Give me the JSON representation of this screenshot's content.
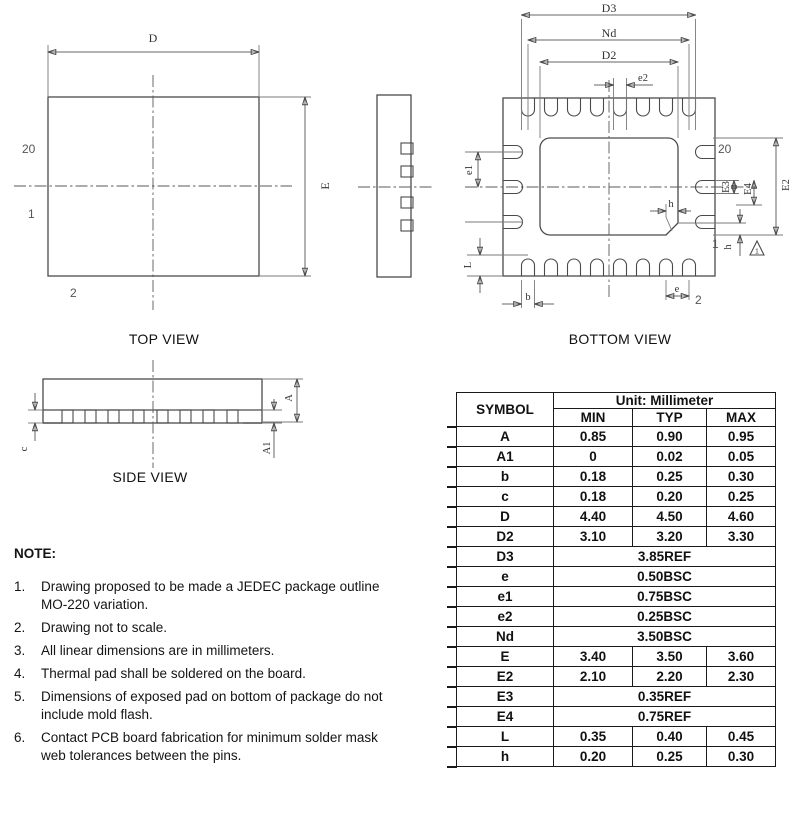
{
  "drawing": {
    "top_view": {
      "title": "TOP VIEW",
      "dim_D": "D",
      "dim_E": "E",
      "pin_20": "20",
      "pin_1": "1",
      "pin_2": "2"
    },
    "bottom_view": {
      "title": "BOTTOM VIEW",
      "dim_D3": "D3",
      "dim_Nd": "Nd",
      "dim_D2": "D2",
      "dim_e2": "e2",
      "dim_e1": "e1",
      "dim_L": "L",
      "dim_b": "b",
      "dim_e": "e",
      "dim_h_top": "h",
      "dim_h_side": "h",
      "dim_E3": "E3",
      "dim_E4": "E4",
      "dim_E2": "E2",
      "pin_20": "20",
      "pin_1": "1",
      "pin_2": "2",
      "note_flag": "1"
    },
    "side_view": {
      "title": "SIDE VIEW",
      "dim_A": "A",
      "dim_A1": "A1",
      "dim_c": "c"
    }
  },
  "notes": {
    "heading": "NOTE:",
    "items": [
      {
        "num": "1.",
        "text": "Drawing proposed to be made a JEDEC package outline MO-220 variation."
      },
      {
        "num": "2.",
        "text": "Drawing not to scale."
      },
      {
        "num": "3.",
        "text": "All linear dimensions are in millimeters."
      },
      {
        "num": "4.",
        "text": "Thermal pad shall be soldered on the board."
      },
      {
        "num": "5.",
        "text": "Dimensions of exposed pad on bottom of package do not include mold flash."
      },
      {
        "num": "6.",
        "text": "Contact PCB board fabrication for minimum solder mask web tolerances between the pins."
      }
    ]
  },
  "table": {
    "symbol_header": "SYMBOL",
    "unit_header": "Unit: Millimeter",
    "columns": [
      "MIN",
      "TYP",
      "MAX"
    ],
    "rows": [
      {
        "symbol": "A",
        "min": "0.85",
        "typ": "0.90",
        "max": "0.95"
      },
      {
        "symbol": "A1",
        "min": "0",
        "typ": "0.02",
        "max": "0.05"
      },
      {
        "symbol": "b",
        "min": "0.18",
        "typ": "0.25",
        "max": "0.30"
      },
      {
        "symbol": "c",
        "min": "0.18",
        "typ": "0.20",
        "max": "0.25"
      },
      {
        "symbol": "D",
        "min": "4.40",
        "typ": "4.50",
        "max": "4.60"
      },
      {
        "symbol": "D2",
        "min": "3.10",
        "typ": "3.20",
        "max": "3.30"
      },
      {
        "symbol": "D3",
        "value": "3.85REF"
      },
      {
        "symbol": "e",
        "value": "0.50BSC"
      },
      {
        "symbol": "e1",
        "value": "0.75BSC"
      },
      {
        "symbol": "e2",
        "value": "0.25BSC"
      },
      {
        "symbol": "Nd",
        "value": "3.50BSC"
      },
      {
        "symbol": "E",
        "min": "3.40",
        "typ": "3.50",
        "max": "3.60"
      },
      {
        "symbol": "E2",
        "min": "2.10",
        "typ": "2.20",
        "max": "2.30"
      },
      {
        "symbol": "E3",
        "value": "0.35REF"
      },
      {
        "symbol": "E4",
        "value": "0.75REF"
      },
      {
        "symbol": "L",
        "min": "0.35",
        "typ": "0.40",
        "max": "0.45"
      },
      {
        "symbol": "h",
        "min": "0.20",
        "typ": "0.25",
        "max": "0.30"
      }
    ]
  },
  "colors": {
    "line": "#4a4a4a",
    "text": "#1a1a1a"
  }
}
